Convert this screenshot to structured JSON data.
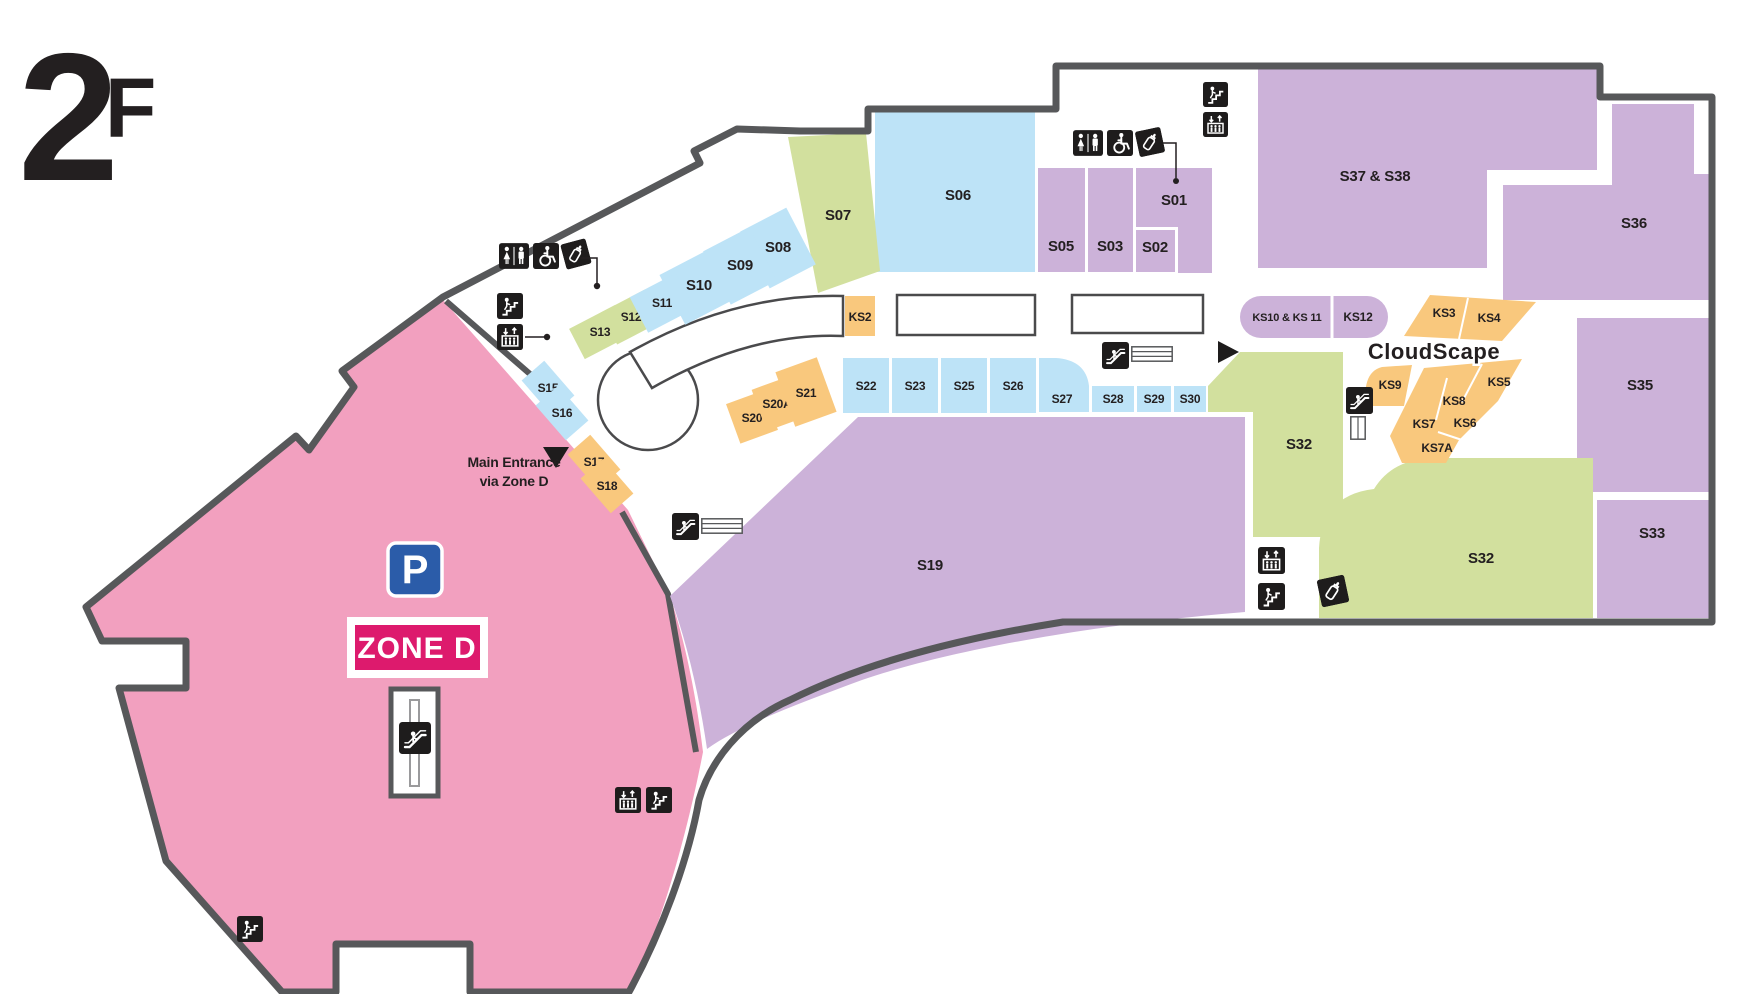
{
  "floor_title": {
    "number": "2",
    "letter": "F"
  },
  "signs": {
    "parking": "P",
    "zone_badge": "ZONE D",
    "entrance_line1": "Main Entrance",
    "entrance_line2": "via Zone D",
    "area_label": "CloudScape"
  },
  "colors": {
    "wall": "#57585a",
    "pink_zone": "#f2a0bf",
    "blue": "#bde3f7",
    "purple": "#ccb2d9",
    "green": "#d2e09e",
    "orange": "#f9c87d",
    "badge_magenta": "#dd1a6d",
    "parking_blue": "#2b5ca9",
    "cloudscape_pink": "#f06db5",
    "icon_black": "#1e1c1c",
    "text": "#231f20"
  },
  "icon_names": [
    "restroom",
    "wheelchair-accessible",
    "baby-care",
    "stairs",
    "elevator",
    "escalator",
    "parking"
  ],
  "shops": [
    {
      "label": "S01",
      "color": "purple"
    },
    {
      "label": "S02",
      "color": "purple"
    },
    {
      "label": "S03",
      "color": "purple"
    },
    {
      "label": "S05",
      "color": "purple"
    },
    {
      "label": "S06",
      "color": "blue"
    },
    {
      "label": "S07",
      "color": "green"
    },
    {
      "label": "S08",
      "color": "blue"
    },
    {
      "label": "S09",
      "color": "blue"
    },
    {
      "label": "S10",
      "color": "blue"
    },
    {
      "label": "S11",
      "color": "blue"
    },
    {
      "label": "S12",
      "color": "green"
    },
    {
      "label": "S13",
      "color": "green"
    },
    {
      "label": "S15",
      "color": "blue"
    },
    {
      "label": "S16",
      "color": "blue"
    },
    {
      "label": "S17",
      "color": "orange"
    },
    {
      "label": "S18",
      "color": "orange"
    },
    {
      "label": "S19",
      "color": "purple"
    },
    {
      "label": "S20",
      "color": "orange"
    },
    {
      "label": "S20A",
      "color": "orange"
    },
    {
      "label": "S21",
      "color": "orange"
    },
    {
      "label": "S22",
      "color": "blue"
    },
    {
      "label": "S23",
      "color": "blue"
    },
    {
      "label": "S25",
      "color": "blue"
    },
    {
      "label": "S26",
      "color": "blue"
    },
    {
      "label": "S27",
      "color": "blue"
    },
    {
      "label": "S28",
      "color": "blue"
    },
    {
      "label": "S29",
      "color": "blue"
    },
    {
      "label": "S30",
      "color": "blue"
    },
    {
      "label": "S32",
      "color": "green"
    },
    {
      "label": "S32",
      "color": "green"
    },
    {
      "label": "S33",
      "color": "purple"
    },
    {
      "label": "S35",
      "color": "purple"
    },
    {
      "label": "S36",
      "color": "purple"
    },
    {
      "label": "S37 & S38",
      "color": "purple"
    },
    {
      "label": "KS2",
      "color": "orange"
    },
    {
      "label": "KS3",
      "color": "orange"
    },
    {
      "label": "KS4",
      "color": "orange"
    },
    {
      "label": "KS5",
      "color": "orange"
    },
    {
      "label": "KS6",
      "color": "orange"
    },
    {
      "label": "KS7",
      "color": "orange"
    },
    {
      "label": "KS7A",
      "color": "orange"
    },
    {
      "label": "KS8",
      "color": "orange"
    },
    {
      "label": "KS9",
      "color": "orange"
    },
    {
      "label": "KS10 & KS 11",
      "color": "purple"
    },
    {
      "label": "KS12",
      "color": "purple"
    }
  ]
}
